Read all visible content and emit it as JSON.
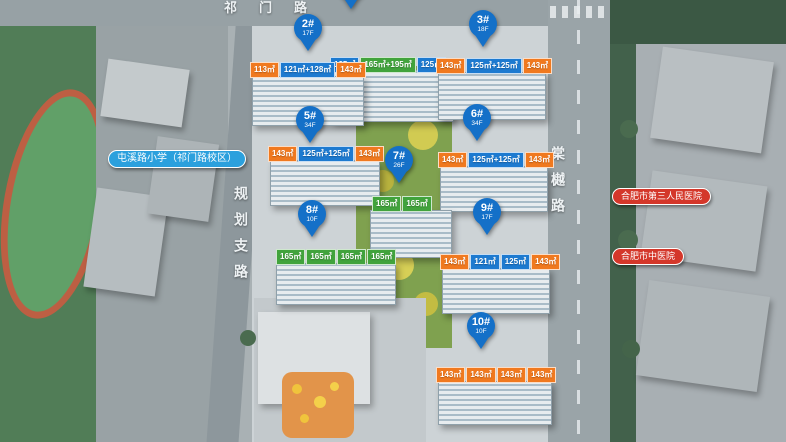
{
  "map": {
    "roads": {
      "top": "祁门路",
      "left": "规划支路",
      "right": "棠樾路"
    },
    "pois": {
      "school": {
        "label": "屯溪路小学（祁门路校区）"
      },
      "hospital_1": {
        "label": "合肥市第三人民医院"
      },
      "hospital_2": {
        "label": "合肥市中医院"
      }
    },
    "colors": {
      "pin": "#1470c8",
      "unit_orange": "#f0791f",
      "unit_blue": "#1d7ad0",
      "unit_green": "#41a33c",
      "poi_blue": "#2ba0dd",
      "poi_red": "#d4372a"
    },
    "buildings": [
      {
        "id": "1#",
        "floors": "",
        "units": [
          {
            "area": "125㎡",
            "color": "blue"
          },
          {
            "area": "165㎡+195㎡",
            "color": "green"
          },
          {
            "area": "125㎡",
            "color": "blue"
          }
        ]
      },
      {
        "id": "2#",
        "floors": "17F",
        "units": [
          {
            "area": "113㎡",
            "color": "orange"
          },
          {
            "area": "121㎡+128㎡",
            "color": "blue"
          },
          {
            "area": "143㎡",
            "color": "orange"
          }
        ]
      },
      {
        "id": "3#",
        "floors": "18F",
        "units": [
          {
            "area": "143㎡",
            "color": "orange"
          },
          {
            "area": "125㎡+125㎡",
            "color": "blue"
          },
          {
            "area": "143㎡",
            "color": "orange"
          }
        ]
      },
      {
        "id": "5#",
        "floors": "34F",
        "units": [
          {
            "area": "143㎡",
            "color": "orange"
          },
          {
            "area": "125㎡+125㎡",
            "color": "blue"
          },
          {
            "area": "143㎡",
            "color": "orange"
          }
        ]
      },
      {
        "id": "6#",
        "floors": "34F",
        "units": [
          {
            "area": "143㎡",
            "color": "orange"
          },
          {
            "area": "125㎡+125㎡",
            "color": "blue"
          },
          {
            "area": "143㎡",
            "color": "orange"
          }
        ]
      },
      {
        "id": "7#",
        "floors": "26F",
        "units": [
          {
            "area": "165㎡",
            "color": "green"
          },
          {
            "area": "165㎡",
            "color": "green"
          }
        ]
      },
      {
        "id": "8#",
        "floors": "10F",
        "units": [
          {
            "area": "165㎡",
            "color": "green"
          },
          {
            "area": "165㎡",
            "color": "green"
          },
          {
            "area": "165㎡",
            "color": "green"
          },
          {
            "area": "165㎡",
            "color": "green"
          }
        ]
      },
      {
        "id": "9#",
        "floors": "17F",
        "units": [
          {
            "area": "143㎡",
            "color": "orange"
          },
          {
            "area": "121㎡",
            "color": "blue"
          },
          {
            "area": "125㎡",
            "color": "blue"
          },
          {
            "area": "143㎡",
            "color": "orange"
          }
        ]
      },
      {
        "id": "10#",
        "floors": "10F",
        "units": [
          {
            "area": "143㎡",
            "color": "orange"
          },
          {
            "area": "143㎡",
            "color": "orange"
          },
          {
            "area": "143㎡",
            "color": "orange"
          },
          {
            "area": "143㎡",
            "color": "orange"
          }
        ]
      }
    ]
  }
}
